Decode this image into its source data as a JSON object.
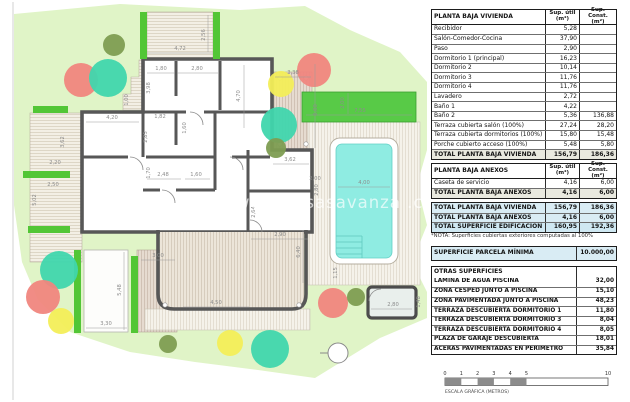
{
  "plan": {
    "watermark": "www.casasavanza .com",
    "colors": {
      "red": "#f0867e",
      "teal": "#40d6ad",
      "yellow": "#f3ee59",
      "olive": "#7e9d52"
    },
    "trees": [
      {
        "x": 114,
        "y": 45,
        "r": 11,
        "c": "olive"
      },
      {
        "x": 81,
        "y": 80,
        "r": 17,
        "c": "red"
      },
      {
        "x": 108,
        "y": 78,
        "r": 19,
        "c": "teal"
      },
      {
        "x": 281,
        "y": 84,
        "r": 13,
        "c": "yellow"
      },
      {
        "x": 314,
        "y": 70,
        "r": 17,
        "c": "red"
      },
      {
        "x": 279,
        "y": 125,
        "r": 18,
        "c": "teal"
      },
      {
        "x": 276,
        "y": 148,
        "r": 10,
        "c": "olive"
      },
      {
        "x": 59,
        "y": 270,
        "r": 19,
        "c": "teal"
      },
      {
        "x": 43,
        "y": 297,
        "r": 17,
        "c": "red"
      },
      {
        "x": 61,
        "y": 321,
        "r": 13,
        "c": "yellow"
      },
      {
        "x": 230,
        "y": 343,
        "r": 13,
        "c": "yellow"
      },
      {
        "x": 270,
        "y": 349,
        "r": 19,
        "c": "teal"
      },
      {
        "x": 333,
        "y": 303,
        "r": 15,
        "c": "red"
      },
      {
        "x": 356,
        "y": 297,
        "r": 9,
        "c": "olive"
      },
      {
        "x": 168,
        "y": 344,
        "r": 9,
        "c": "olive"
      }
    ],
    "dimensions": [
      {
        "t": "4,72",
        "x": 180,
        "y": 50,
        "rot": 0,
        "l": [
          147,
          53,
          213,
          53
        ]
      },
      {
        "t": "2,56",
        "x": 205,
        "y": 35,
        "rot": 1,
        "l": [
          208,
          15,
          208,
          52
        ]
      },
      {
        "t": "1,80",
        "x": 161,
        "y": 70,
        "rot": 0,
        "l": [
          147,
          73,
          175,
          73
        ]
      },
      {
        "t": "2,80",
        "x": 197,
        "y": 70,
        "rot": 0,
        "l": [
          177,
          73,
          218,
          73
        ]
      },
      {
        "t": "3,98",
        "x": 150,
        "y": 88,
        "rot": 1
      },
      {
        "t": "4,70",
        "x": 240,
        "y": 96,
        "rot": 1,
        "l": [
          244,
          65,
          244,
          128
        ]
      },
      {
        "t": "1,82",
        "x": 160,
        "y": 118,
        "rot": 0
      },
      {
        "t": "1,60",
        "x": 186,
        "y": 128,
        "rot": 1
      },
      {
        "t": "4,20",
        "x": 112,
        "y": 119,
        "rot": 0,
        "l": [
          86,
          122,
          139,
          122
        ]
      },
      {
        "t": "2,85",
        "x": 147,
        "y": 137,
        "rot": 1
      },
      {
        "t": "1,70",
        "x": 150,
        "y": 173,
        "rot": 1
      },
      {
        "t": "2,48",
        "x": 163,
        "y": 176,
        "rot": 0,
        "l": [
          147,
          179,
          181,
          179
        ]
      },
      {
        "t": "1,60",
        "x": 196,
        "y": 176,
        "rot": 0,
        "l": [
          185,
          179,
          210,
          179
        ]
      },
      {
        "t": "3,62",
        "x": 290,
        "y": 161,
        "rot": 0,
        "l": [
          273,
          164,
          309,
          164
        ]
      },
      {
        "t": "2,80",
        "x": 318,
        "y": 190,
        "rot": 1
      },
      {
        "t": "2,90",
        "x": 280,
        "y": 236,
        "rot": 0,
        "l": [
          251,
          239,
          308,
          239
        ]
      },
      {
        "t": "2,64",
        "x": 255,
        "y": 212,
        "rot": 1
      },
      {
        "t": "1,00",
        "x": 128,
        "y": 100,
        "rot": 1
      },
      {
        "t": "3,62",
        "x": 64,
        "y": 142,
        "rot": 1
      },
      {
        "t": "2,20",
        "x": 55,
        "y": 164,
        "rot": 0
      },
      {
        "t": "2,50",
        "x": 53,
        "y": 186,
        "rot": 0
      },
      {
        "t": "5,02",
        "x": 36,
        "y": 200,
        "rot": 1
      },
      {
        "t": "3,30",
        "x": 106,
        "y": 325,
        "rot": 0,
        "l": [
          86,
          328,
          127,
          328
        ]
      },
      {
        "t": "5,48",
        "x": 121,
        "y": 290,
        "rot": 1,
        "l": [
          124,
          252,
          124,
          330
        ]
      },
      {
        "t": "3,00",
        "x": 158,
        "y": 257,
        "rot": 0,
        "l": [
          141,
          260,
          175,
          260
        ]
      },
      {
        "t": "4,50",
        "x": 216,
        "y": 304,
        "rot": 0,
        "l": [
          183,
          307,
          249,
          307
        ]
      },
      {
        "t": "6,40",
        "x": 300,
        "y": 252,
        "rot": 1,
        "l": [
          303,
          230,
          303,
          283
        ]
      },
      {
        "t": "1,15",
        "x": 337,
        "y": 273,
        "rot": 1
      },
      {
        "t": "2,00",
        "x": 315,
        "y": 180,
        "rot": 0
      },
      {
        "t": "7,55",
        "x": 360,
        "y": 112,
        "rot": 0,
        "l": [
          306,
          115,
          412,
          115
        ]
      },
      {
        "t": "2,00",
        "x": 344,
        "y": 103,
        "rot": 1,
        "l": [
          348,
          93,
          348,
          114
        ]
      },
      {
        "t": "4,00",
        "x": 364,
        "y": 184,
        "rot": 0,
        "l": [
          338,
          187,
          390,
          187
        ]
      },
      {
        "t": "2,80",
        "x": 393,
        "y": 306,
        "rot": 0,
        "l": [
          371,
          309,
          412,
          309
        ]
      },
      {
        "t": "1,48",
        "x": 420,
        "y": 302,
        "rot": 1
      },
      {
        "t": "3,38",
        "x": 293,
        "y": 74,
        "rot": 0,
        "l": [
          275,
          77,
          311,
          77
        ]
      },
      {
        "t": "6,00",
        "x": 317,
        "y": 110,
        "rot": 1,
        "l": [
          315,
          64,
          315,
          148
        ]
      }
    ],
    "scale_bar": {
      "ticks": [
        {
          "t": "0",
          "m": 0
        },
        {
          "t": "1",
          "m": 1
        },
        {
          "t": "2",
          "m": 2
        },
        {
          "t": "3",
          "m": 3
        },
        {
          "t": "4",
          "m": 4
        },
        {
          "t": "5",
          "m": 5
        },
        {
          "t": "10",
          "m": 10
        }
      ],
      "filled_from_m": [
        0,
        2,
        4
      ],
      "label": "ESCALA GRÁFICA (METROS)"
    }
  },
  "tables": {
    "vivienda": {
      "title": "PLANTA BAJA VIVIENDA",
      "col_util": "Sup. útil (m²)",
      "col_const": "Sup. Const. (m²)",
      "rows": [
        [
          "Recibidor",
          "5,28",
          ""
        ],
        [
          "Salón-Comedor-Cocina",
          "37,90",
          ""
        ],
        [
          "Paso",
          "2,90",
          ""
        ],
        [
          "Dormitorio 1 (principal)",
          "16,23",
          ""
        ],
        [
          "Dormitorio 2",
          "10,14",
          ""
        ],
        [
          "Dormitorio 3",
          "11,76",
          ""
        ],
        [
          "Dormitorio 4",
          "11,76",
          ""
        ],
        [
          "Lavadero",
          "2,72",
          ""
        ],
        [
          "Baño 1",
          "4,22",
          ""
        ],
        [
          "Baño 2",
          "5,36",
          "136,88"
        ],
        [
          "Terraza cubierta salón (100%)",
          "27,24",
          "28,20"
        ],
        [
          "Terraza cubierta dormitorios (100%)",
          "15,80",
          "15,48"
        ],
        [
          "Porche cubierto acceso (100%)",
          "5,48",
          "5,80"
        ]
      ],
      "total": [
        "TOTAL PLANTA BAJA VIVIENDA",
        "156,79",
        "186,36"
      ]
    },
    "anexos": {
      "title": "PLANTA BAJA ANEXOS",
      "col_util": "Sup. útil (m²)",
      "col_const": "Sup. Const. (m²)",
      "rows": [
        [
          "Caseta de servicio",
          "4,16",
          "6,00"
        ]
      ],
      "total": [
        "TOTAL PLANTA BAJA ANEXOS",
        "4,16",
        "6,00"
      ]
    },
    "summary": {
      "rows": [
        [
          "TOTAL PLANTA BAJA VIVIENDA",
          "156,79",
          "186,36"
        ],
        [
          "TOTAL PLANTA BAJA ANEXOS",
          "4,16",
          "6,00"
        ],
        [
          "TOTAL SUPERFICIE EDIFICACIÓN",
          "160,95",
          "192,36"
        ]
      ],
      "note": "*NOTA: Superficies cubiertas exteriores computadas al 100%"
    },
    "parcela": {
      "label": "SUPERFICIE PARCELA MÍNIMA",
      "value": "10.000,00"
    },
    "otras": {
      "title": "OTRAS SUPERFICIES",
      "rows": [
        [
          "LÁMINA DE AGUA PISCINA",
          "32,00"
        ],
        [
          "ZONA CÉSPED JUNTO A PISCINA",
          "15,10"
        ],
        [
          "ZONA PAVIMENTADA JUNTO A PISCINA",
          "48,23"
        ],
        [
          "TERRAZA DESCUBIERTA DORMITORIO 1",
          "11,80"
        ],
        [
          "TERRAZA DESCUBIERTA DORMITORIO 3",
          "8,04"
        ],
        [
          "TERRAZA DESCUBIERTA DORMITORIO 4",
          "8,05"
        ],
        [
          "PLAZA DE GARAJE DESCUBIERTA",
          "18,01"
        ],
        [
          "ACERAS PAVIMENTADAS EN PERÍMETRO",
          "35,84"
        ]
      ]
    }
  }
}
